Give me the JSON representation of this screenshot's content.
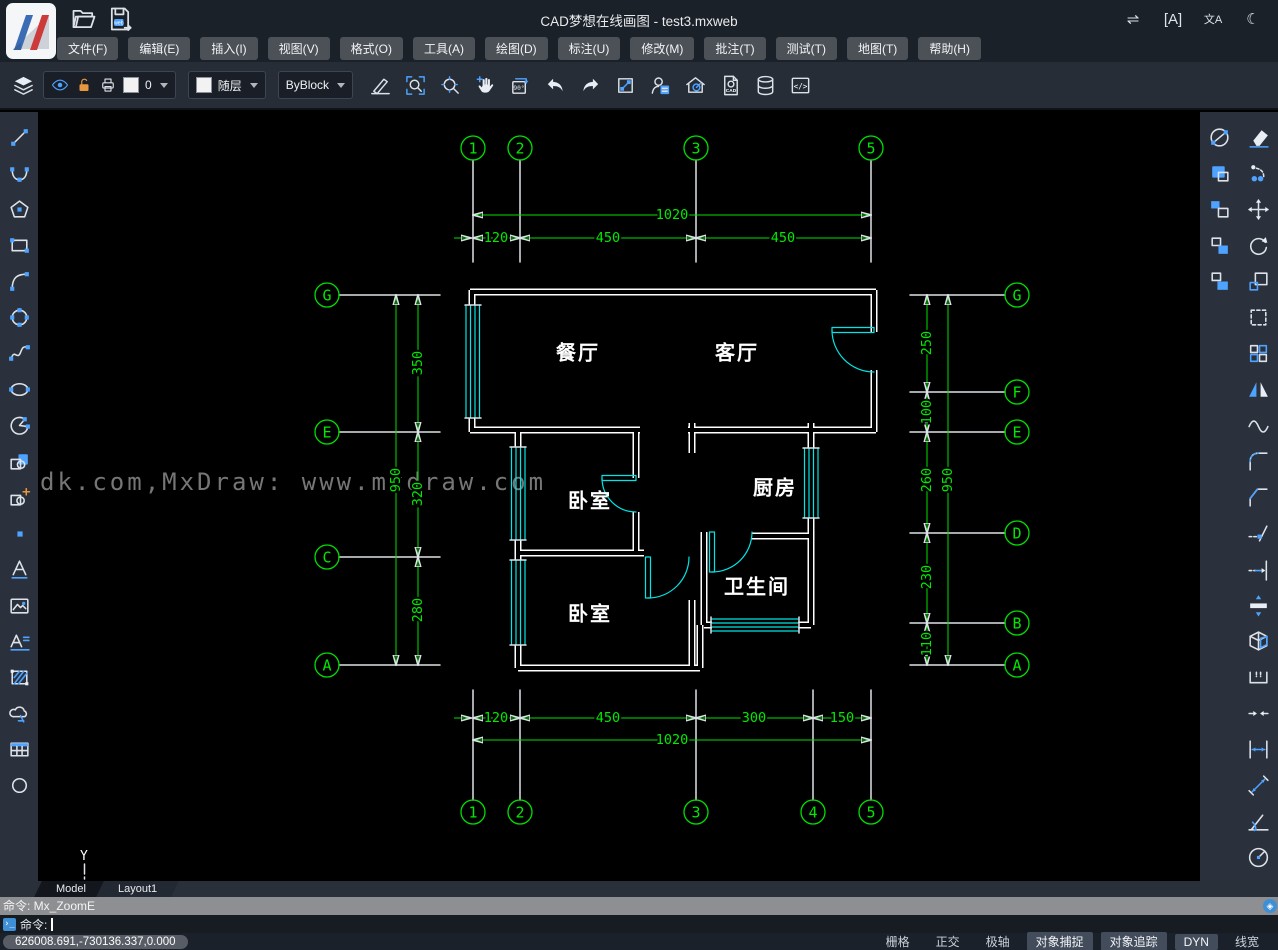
{
  "window": {
    "title": "CAD梦想在线画图 - test3.mxweb"
  },
  "titlebar": {
    "icons": [
      {
        "name": "swap-horizontal-icon",
        "glyph": "⇌"
      },
      {
        "name": "find-text-icon",
        "glyph": "[A]"
      },
      {
        "name": "translate-icon",
        "glyph": "文A"
      },
      {
        "name": "night-mode-icon",
        "glyph": "☾"
      }
    ]
  },
  "quickbar": {
    "icons": [
      "open-folder",
      "save-web"
    ]
  },
  "menubar": {
    "items": [
      "文件(F)",
      "编辑(E)",
      "插入(I)",
      "视图(V)",
      "格式(O)",
      "工具(A)",
      "绘图(D)",
      "标注(U)",
      "修改(M)",
      "批注(T)",
      "测试(T)",
      "地图(T)",
      "帮助(H)"
    ]
  },
  "toolbar": {
    "layer_current": "0",
    "color_current": "随层",
    "linetype_current": "ByBlock",
    "icons": [
      "layers",
      "eye",
      "unlock",
      "printer",
      "lineweight-pen",
      "zoom-window",
      "zoom-extents",
      "pan",
      "rotate-90",
      "undo",
      "redo",
      "measure",
      "user-list",
      "home-design",
      "cad-file",
      "database",
      "code"
    ]
  },
  "sidebar_left": {
    "tools": [
      "line",
      "arc",
      "polygon",
      "rectangle",
      "arc-start-end",
      "circle",
      "spline",
      "ellipse",
      "pie",
      "insert-block",
      "insert-block-plus",
      "point",
      "text",
      "image",
      "mtext",
      "hatch",
      "revision-cloud",
      "table",
      "donut"
    ]
  },
  "sidebar_right": {
    "col1": [
      "construction-line",
      "copy-object",
      "paste-block",
      "copy-block",
      "copy-with-base"
    ],
    "col2": [
      "erase",
      "copy",
      "move",
      "rotate",
      "scale",
      "select",
      "array",
      "mirror",
      "fit-spline",
      "fillet",
      "chamfer",
      "trim",
      "extend",
      "stretch",
      "explode",
      "break",
      "join",
      "dim-linear",
      "dim-aligned",
      "dim-angular",
      "dim-radius"
    ]
  },
  "drawing": {
    "watermark": "dk.com,MxDraw: www.mxdraw.com",
    "ucs_axis": "Y",
    "rooms": {
      "dining": "餐厅",
      "living": "客厅",
      "bedroom1": "卧室",
      "kitchen": "厨房",
      "bathroom": "卫生间",
      "bedroom2": "卧室"
    },
    "axis_bubbles": {
      "top": [
        "1",
        "2",
        "3",
        "5"
      ],
      "bottom": [
        "1",
        "2",
        "3",
        "4",
        "5"
      ],
      "left": [
        "G",
        "E",
        "C",
        "A"
      ],
      "right": [
        "G",
        "F",
        "E",
        "D",
        "B",
        "A"
      ]
    },
    "dimensions": {
      "top_overall": "1020",
      "top_segments": [
        "120",
        "450",
        "450"
      ],
      "bottom_segments": [
        "120",
        "450",
        "300",
        "150"
      ],
      "bottom_overall": "1020",
      "left_segments": [
        "350",
        "320",
        "280"
      ],
      "left_overall": "950",
      "right_segments": [
        "250",
        "100",
        "260",
        "230",
        "110"
      ],
      "right_overall": "950"
    },
    "colors": {
      "dimension": "#00e000",
      "wall": "#ffffff",
      "door_window": "#00e5e5",
      "watermark": "#7a7a7a"
    }
  },
  "tabs": [
    {
      "label": "Model",
      "active": true
    },
    {
      "label": "Layout1",
      "active": false
    }
  ],
  "command": {
    "history": "命令: Mx_ZoomE",
    "prompt": "命令:"
  },
  "statusbar": {
    "coordinates": "626008.691,-730136.337,0.000",
    "toggles": [
      {
        "label": "栅格",
        "active": false
      },
      {
        "label": "正交",
        "active": false
      },
      {
        "label": "极轴",
        "active": false
      },
      {
        "label": "对象捕捉",
        "active": true
      },
      {
        "label": "对象追踪",
        "active": true
      },
      {
        "label": "DYN",
        "active": true
      },
      {
        "label": "线宽",
        "active": false
      }
    ]
  }
}
